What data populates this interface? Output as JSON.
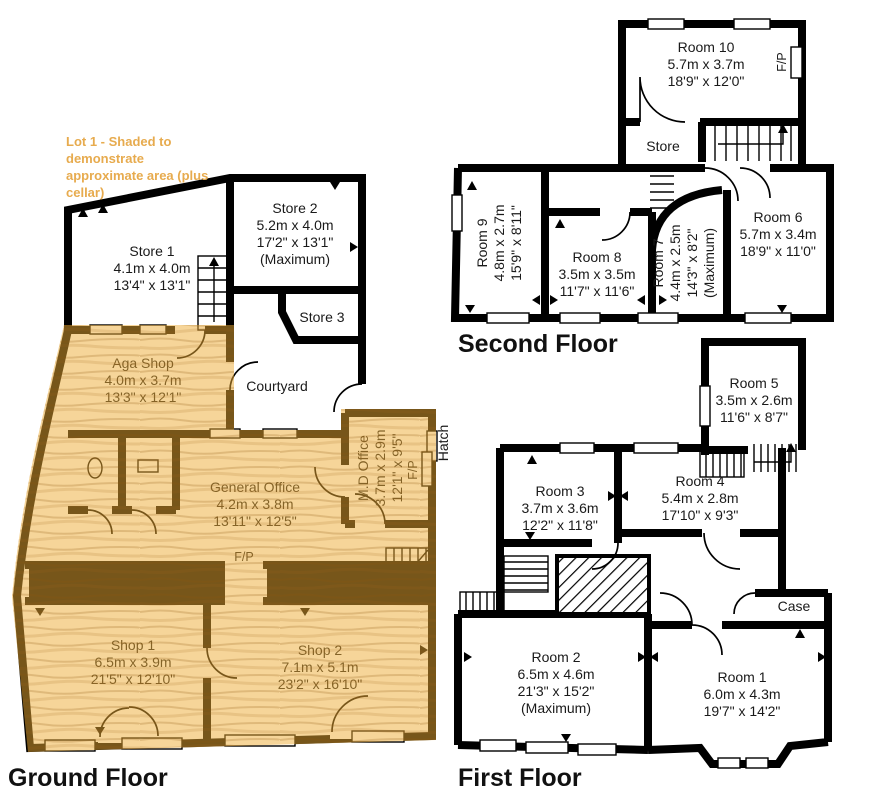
{
  "lot_note": {
    "lines": [
      "Lot 1 - Shaded to",
      "demonstrate",
      "approximate area (plus",
      "cellar)"
    ]
  },
  "labels": {
    "fp": "F/P",
    "hatch": "Hatch"
  },
  "colors": {
    "shade": "rgba(238,172,52,0.5)",
    "note_text": "#e7ab4e",
    "wall": "#000000"
  },
  "floors": [
    {
      "name": "Ground Floor",
      "rooms": [
        {
          "name": "Store 1",
          "metric": "4.1m x 4.0m",
          "imperial": "13'4\" x 13'1\""
        },
        {
          "name": "Store 2",
          "metric": "5.2m x 4.0m",
          "imperial": "17'2\" x 13'1\"",
          "note": "(Maximum)"
        },
        {
          "name": "Store 3"
        },
        {
          "name": "Courtyard"
        },
        {
          "name": "Aga Shop",
          "metric": "4.0m x 3.7m",
          "imperial": "13'3\" x 12'1\""
        },
        {
          "name": "General Office",
          "metric": "4.2m x 3.8m",
          "imperial": "13'11\" x 12'5\""
        },
        {
          "name": "M.D Office",
          "metric": "3.7m x 2.9m",
          "imperial": "12'1\" x 9'5\""
        },
        {
          "name": "Shop 1",
          "metric": "6.5m x 3.9m",
          "imperial": "21'5\" x 12'10\""
        },
        {
          "name": "Shop 2",
          "metric": "7.1m x 5.1m",
          "imperial": "23'2\" x 16'10\""
        }
      ]
    },
    {
      "name": "Second Floor",
      "rooms": [
        {
          "name": "Room 10",
          "metric": "5.7m x 3.7m",
          "imperial": "18'9\" x 12'0\""
        },
        {
          "name": "Store"
        },
        {
          "name": "Room 9",
          "metric": "4.8m x 2.7m",
          "imperial": "15'9\" x 8'11\""
        },
        {
          "name": "Room 8",
          "metric": "3.5m x 3.5m",
          "imperial": "11'7\" x 11'6\""
        },
        {
          "name": "Room 7",
          "metric": "4.4m x 2.5m",
          "imperial": "14'3\" x 8'2\"",
          "note": "(Maximum)"
        },
        {
          "name": "Room 6",
          "metric": "5.7m x 3.4m",
          "imperial": "18'9\" x 11'0\""
        }
      ]
    },
    {
      "name": "First Floor",
      "rooms": [
        {
          "name": "Room 5",
          "metric": "3.5m x 2.6m",
          "imperial": "11'6\" x 8'7\""
        },
        {
          "name": "Room 3",
          "metric": "3.7m x 3.6m",
          "imperial": "12'2\" x 11'8\""
        },
        {
          "name": "Room 4",
          "metric": "5.4m x 2.8m",
          "imperial": "17'10\" x 9'3\""
        },
        {
          "name": "Case"
        },
        {
          "name": "Room 2",
          "metric": "6.5m x 4.6m",
          "imperial": "21'3\" x 15'2\"",
          "note": "(Maximum)"
        },
        {
          "name": "Room 1",
          "metric": "6.0m x 4.3m",
          "imperial": "19'7\" x 14'2\""
        }
      ]
    }
  ]
}
